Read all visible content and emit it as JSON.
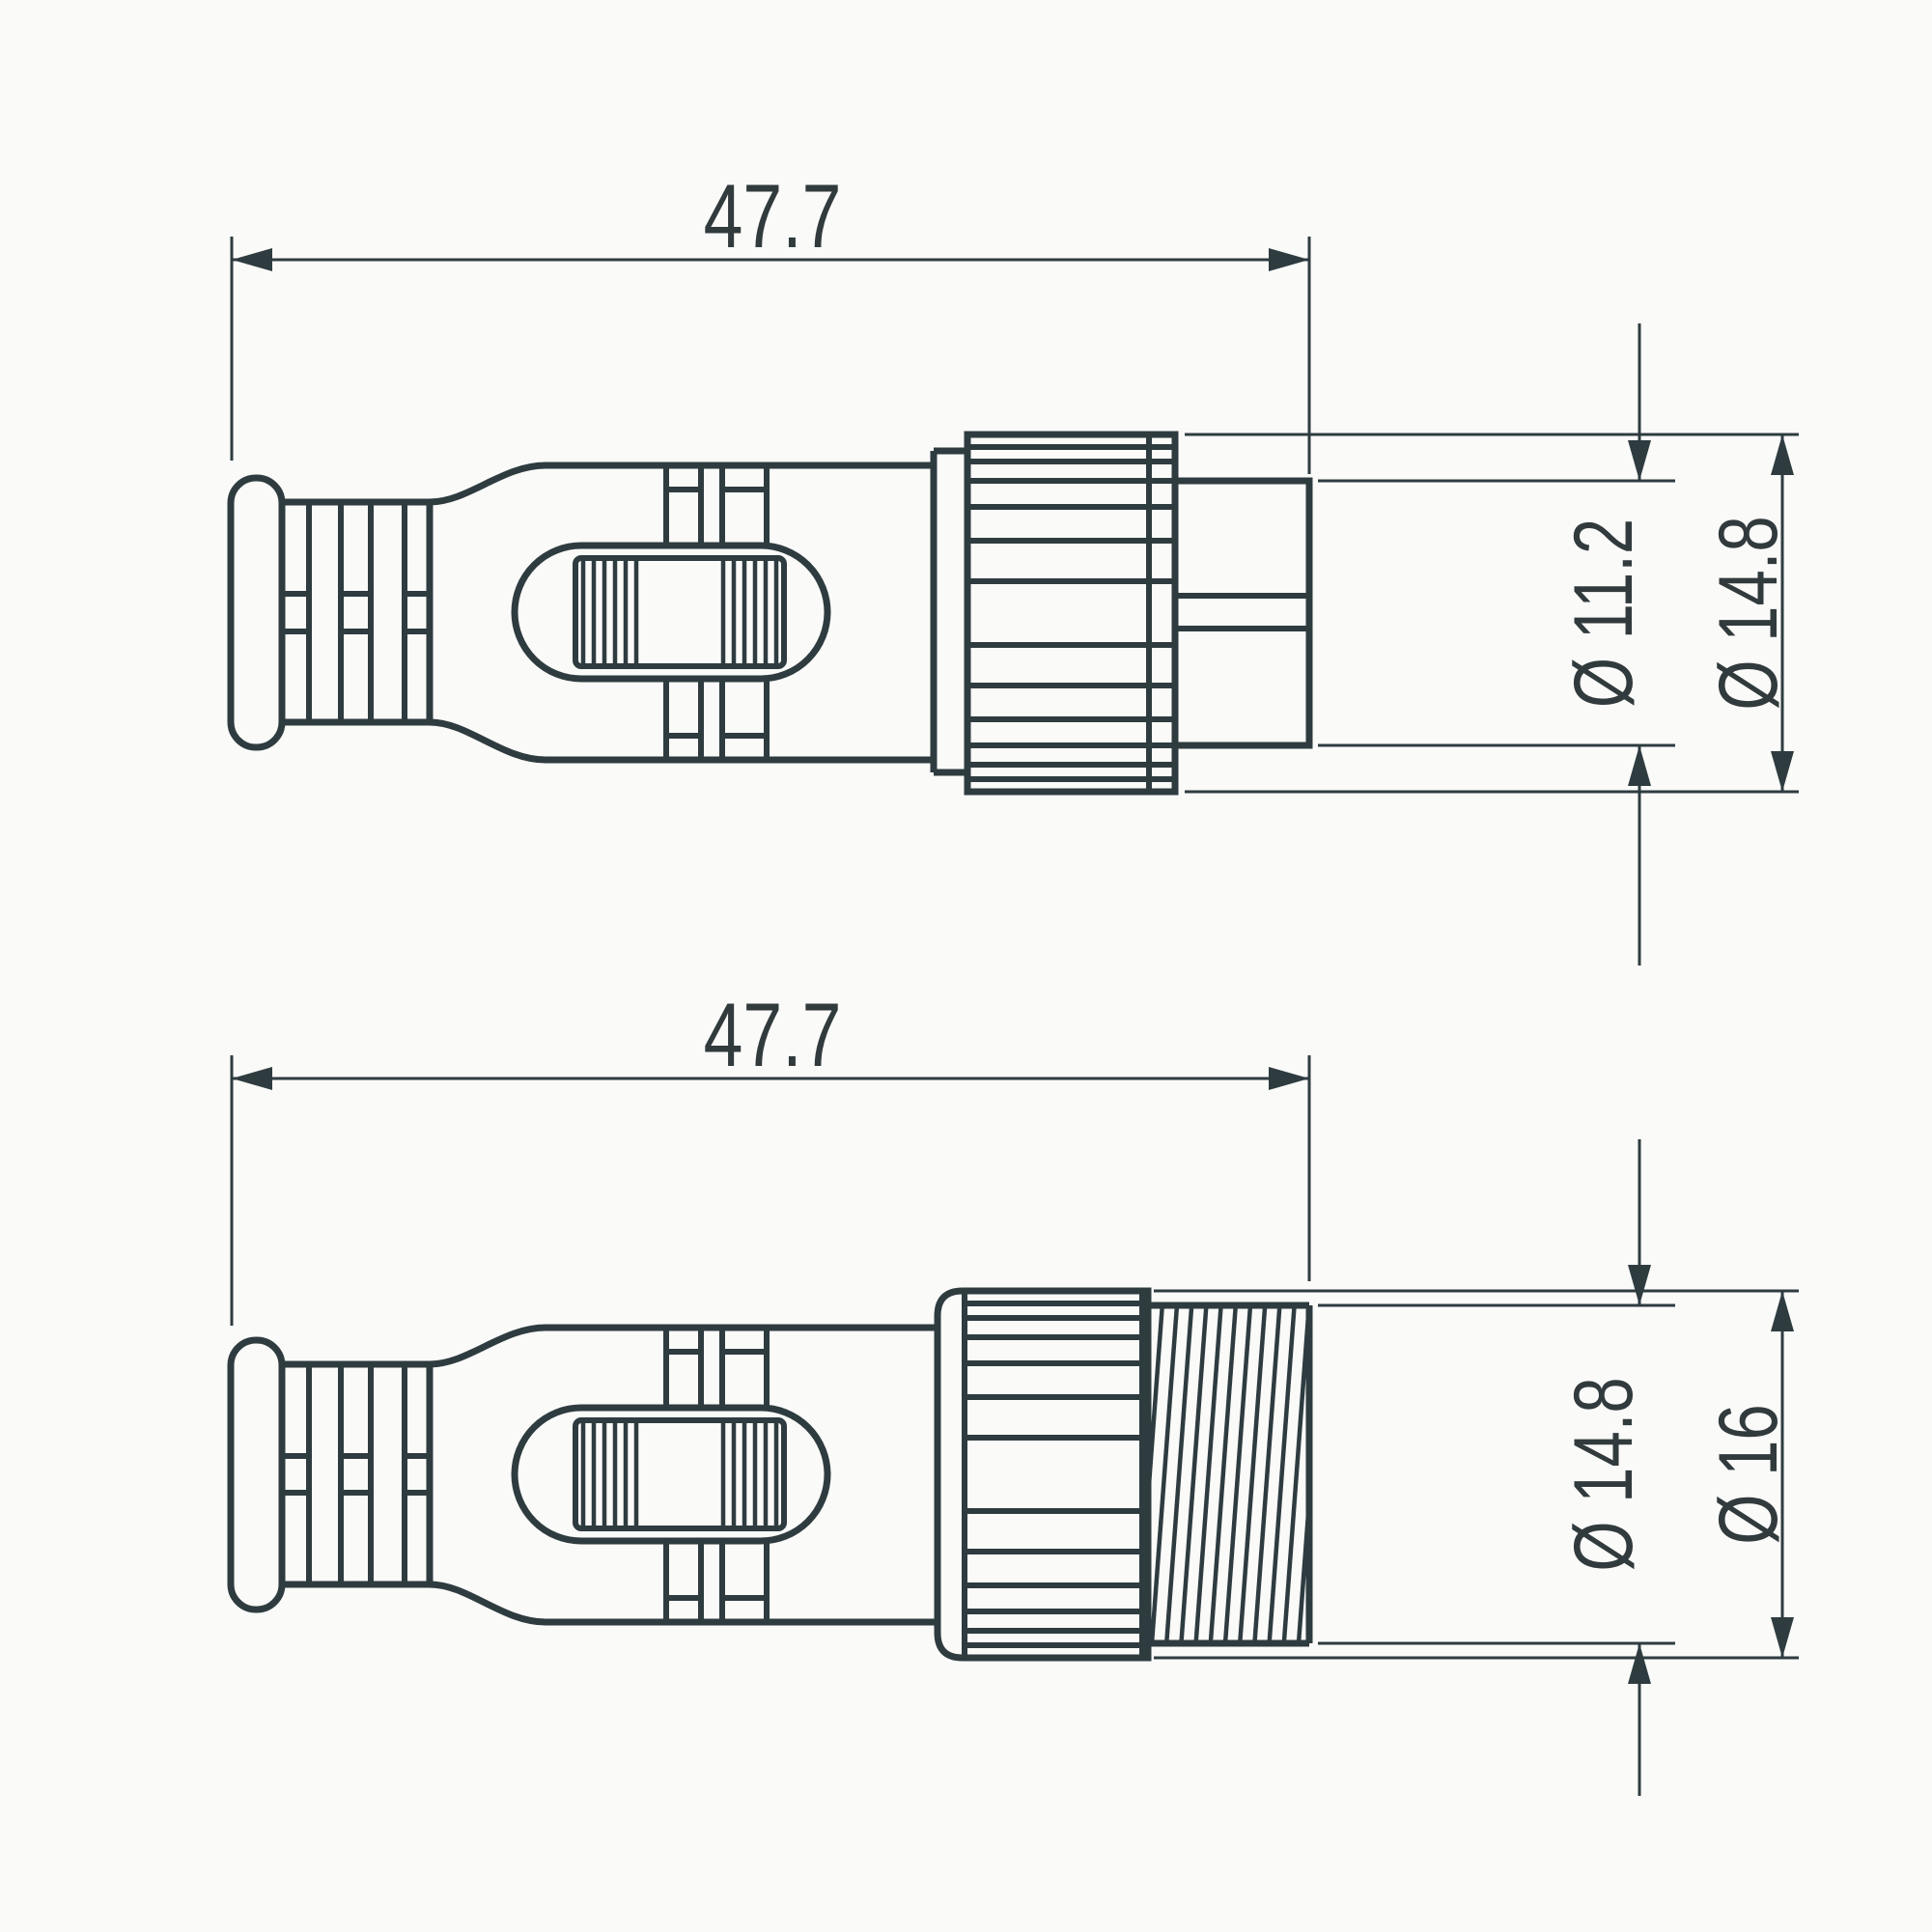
{
  "canvas": {
    "background": "#fafaf8",
    "line_color": "#2e3c40",
    "text_color": "#313a3c"
  },
  "views": [
    {
      "id": "top",
      "name": "male-connector-side-view",
      "length": {
        "label": "47.7"
      },
      "diameters": [
        {
          "label": "Ø 11.2"
        },
        {
          "label": "Ø 14.8"
        }
      ]
    },
    {
      "id": "bottom",
      "name": "female-connector-side-view",
      "length": {
        "label": "47.7"
      },
      "diameters": [
        {
          "label": "Ø 14.8"
        },
        {
          "label": "Ø 16"
        }
      ]
    }
  ]
}
